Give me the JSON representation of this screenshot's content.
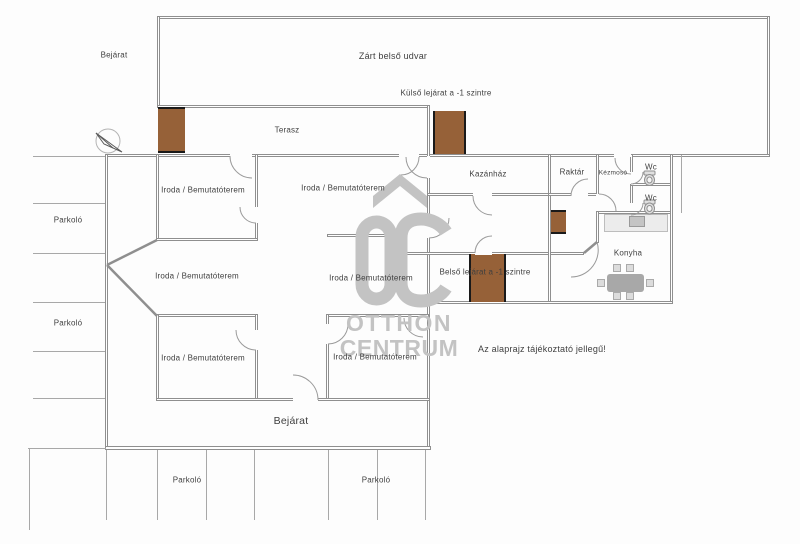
{
  "plan_type": "floor-plan",
  "labels": {
    "courtyard": "Zárt belső udvar",
    "terrace": "Terasz",
    "entrance": "Bejárat",
    "parking": "Parkoló",
    "office": "Iroda / Bemutatóterem",
    "boiler_room": "Kazánház",
    "storage": "Raktár",
    "handwash": "Kézmosó",
    "wc": "Wc",
    "kitchen": "Konyha",
    "external_stairs_down": "Külső lejárat a -1 szintre",
    "internal_stairs_down": "Belső lejárat a -1 szintre"
  },
  "disclaimer": "Az alaprajz tájékoztató jellegű!",
  "watermark": {
    "line1": "OTTHON",
    "line2": "CENTRUM",
    "color": "#c3c3c3"
  },
  "colors": {
    "wall": "#8f8f8f",
    "stairs_brown": "#966138",
    "text": "#3f3f3f",
    "furniture_gray": "#b9b9b9"
  }
}
